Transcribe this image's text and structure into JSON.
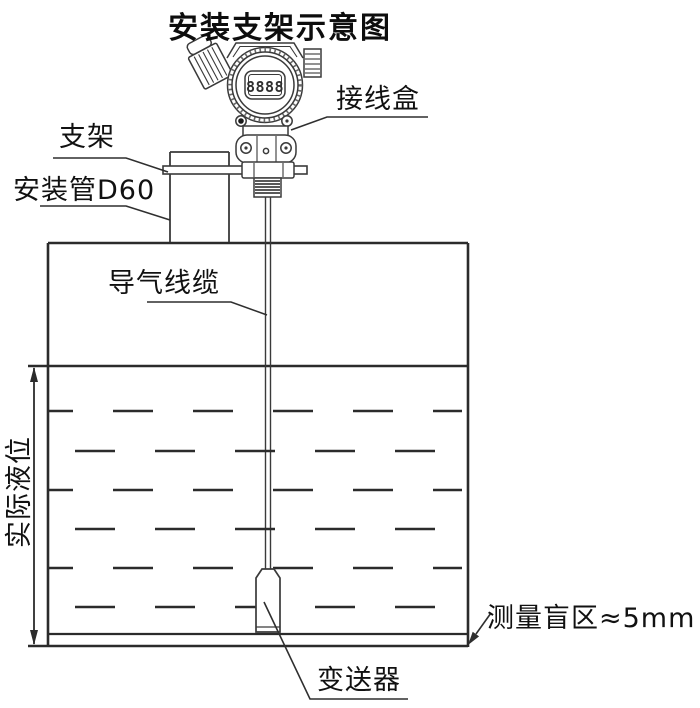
{
  "title": "安装支架示意图",
  "labels": {
    "junction_box": "接线盒",
    "bracket": "支架",
    "mounting_pipe": "安装管D60",
    "air_cable": "导气线缆",
    "actual_level": "实际液位",
    "blind_zone": "测量盲区≈5mm",
    "transmitter": "变送器"
  },
  "display_value": "8888",
  "colors": {
    "line": "#2b2b2b",
    "detail_line": "#3a3a3a",
    "text": "#111111",
    "background": "#ffffff"
  }
}
